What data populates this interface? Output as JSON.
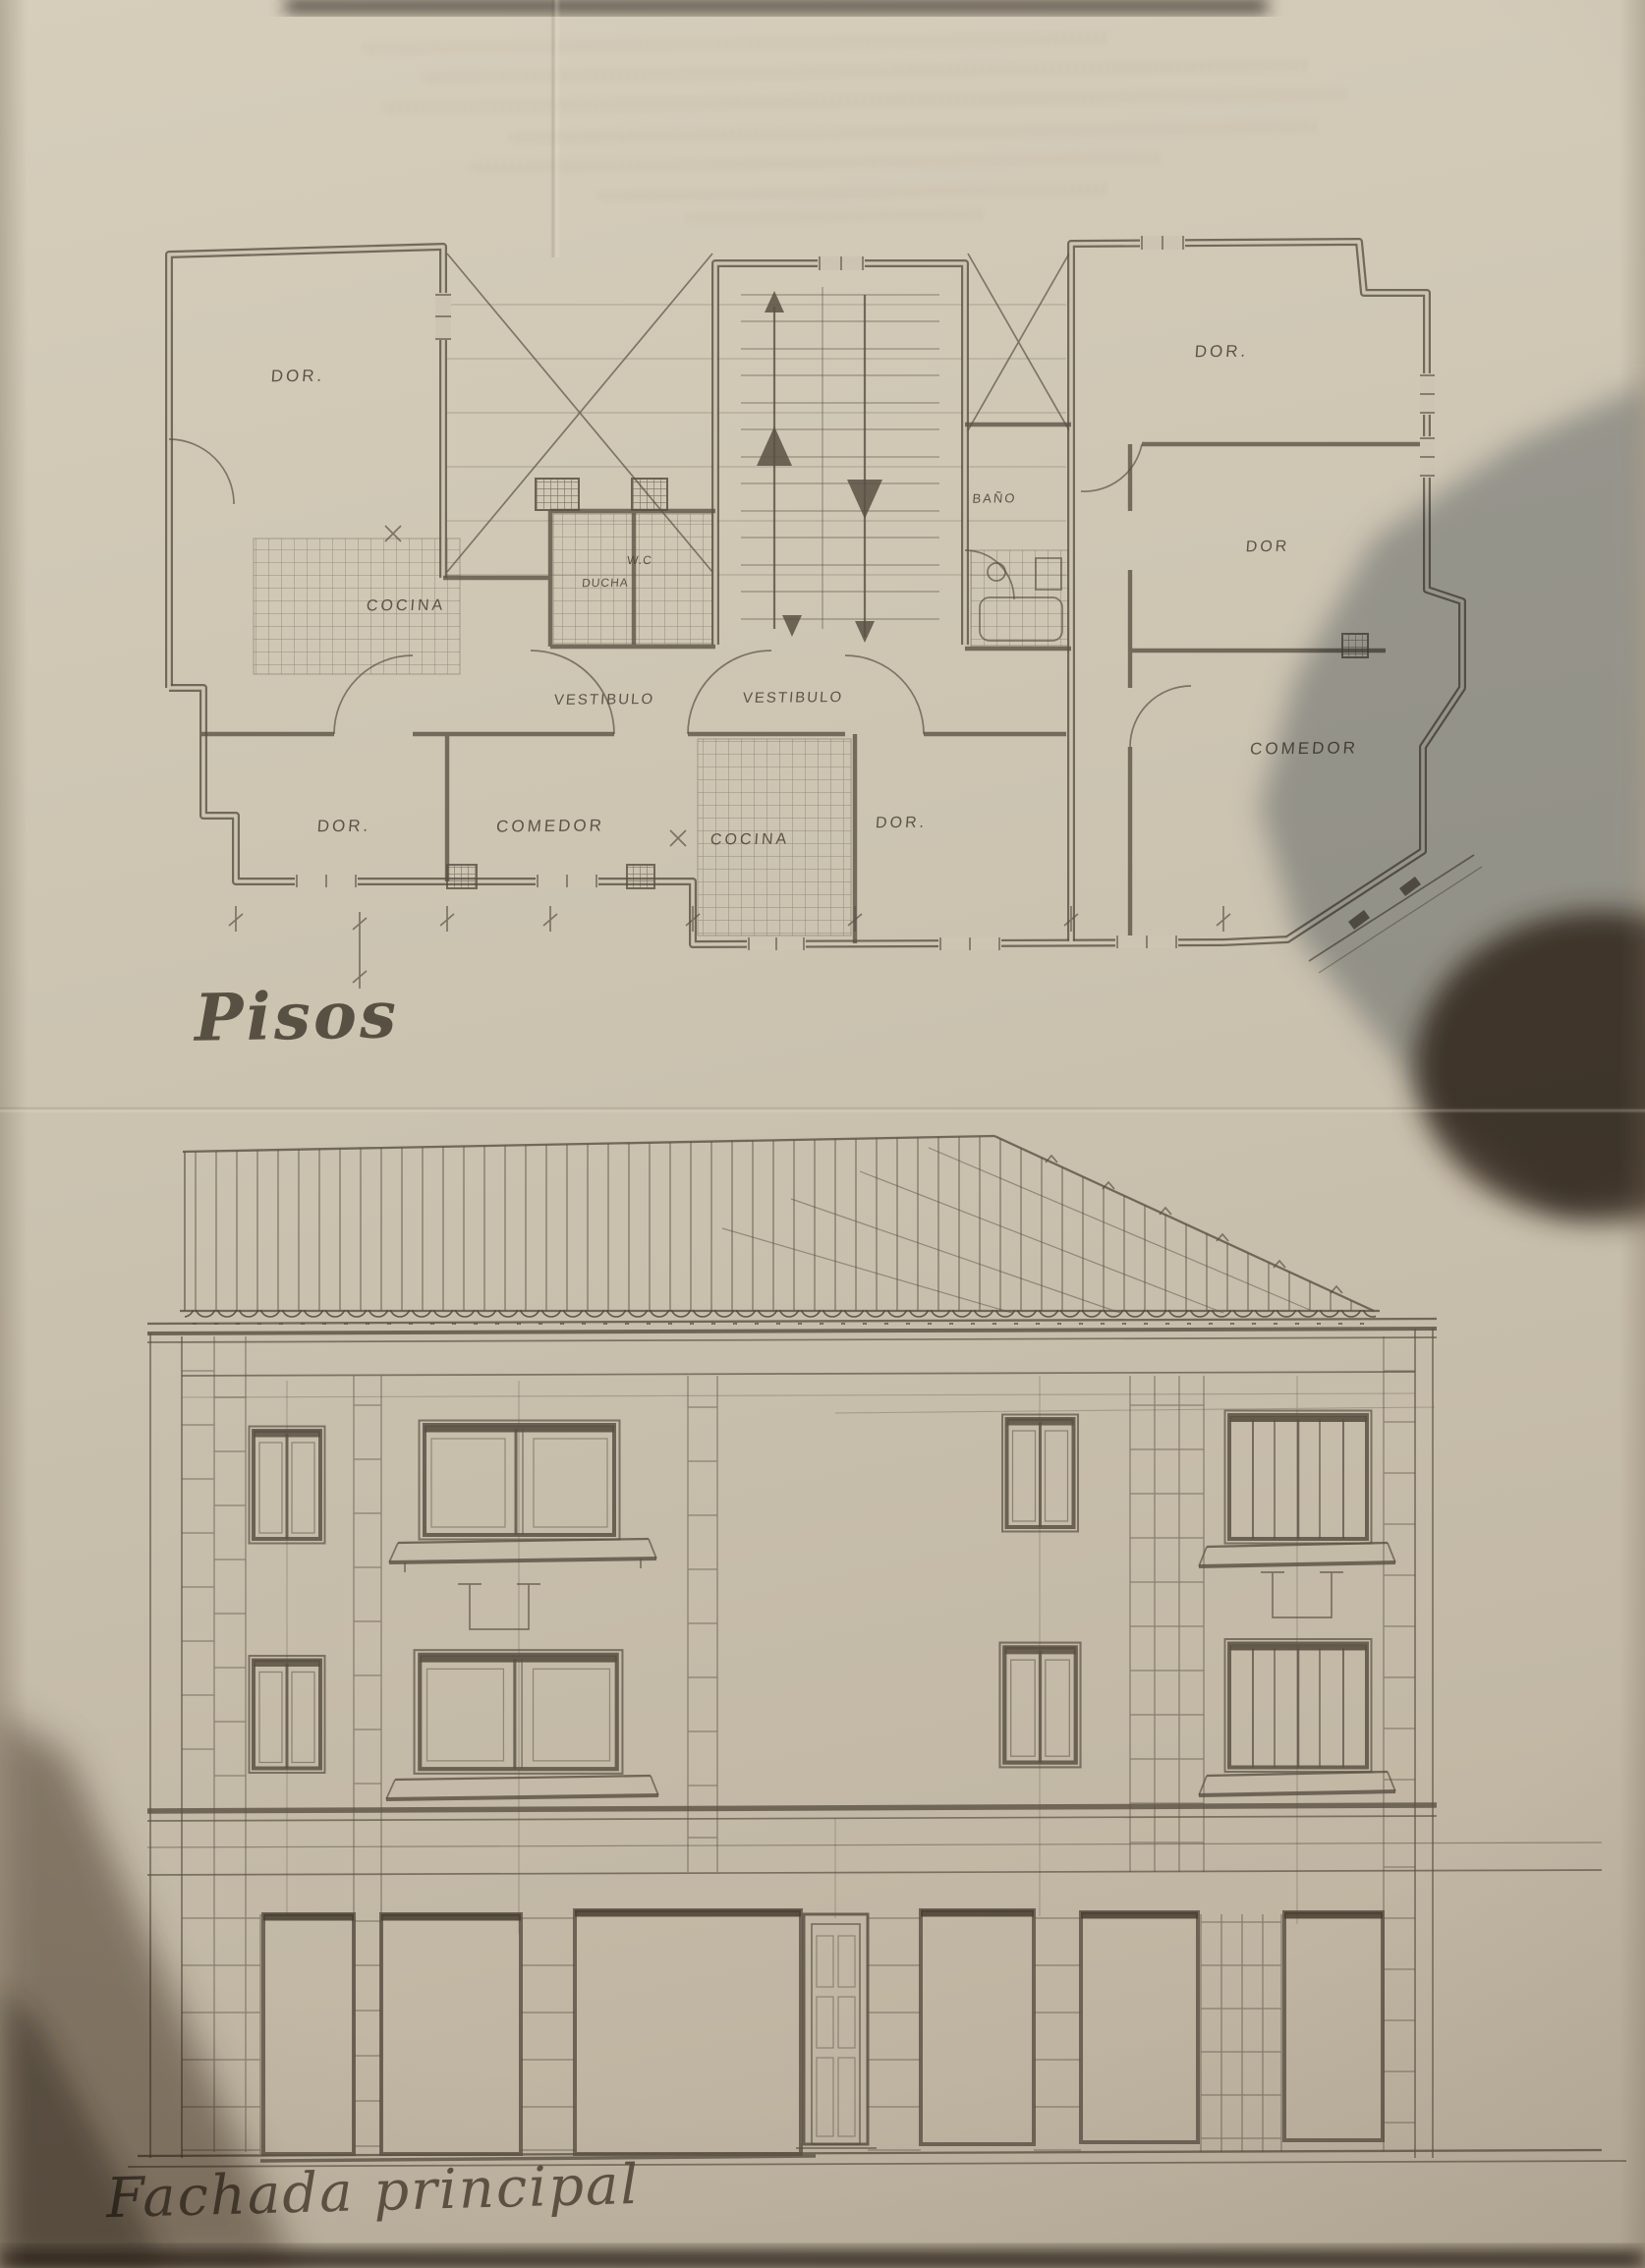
{
  "palette": {
    "paper": "#cbc2b0",
    "paper2": "#cdc4b2",
    "pencil": "#5a5144",
    "dark": "#463d30",
    "shadow_gray": "#74828d",
    "shadow_brown": "#382b1f"
  },
  "plan": {
    "title": "Pisos",
    "rooms": [
      {
        "label": "DOR."
      },
      {
        "label": "COCINA"
      },
      {
        "label": "W.C"
      },
      {
        "label": "DUCHA"
      },
      {
        "label": "BAÑO"
      },
      {
        "label": "VESTIBULO"
      },
      {
        "label": "VESTIBULO"
      },
      {
        "label": "DOR."
      },
      {
        "label": "DOR"
      },
      {
        "label": "COMEDOR"
      },
      {
        "label": "DOR."
      },
      {
        "label": "COMEDOR"
      },
      {
        "label": "COCINA"
      },
      {
        "label": "DOR."
      }
    ]
  },
  "facade": {
    "title": "Fachada principal"
  }
}
